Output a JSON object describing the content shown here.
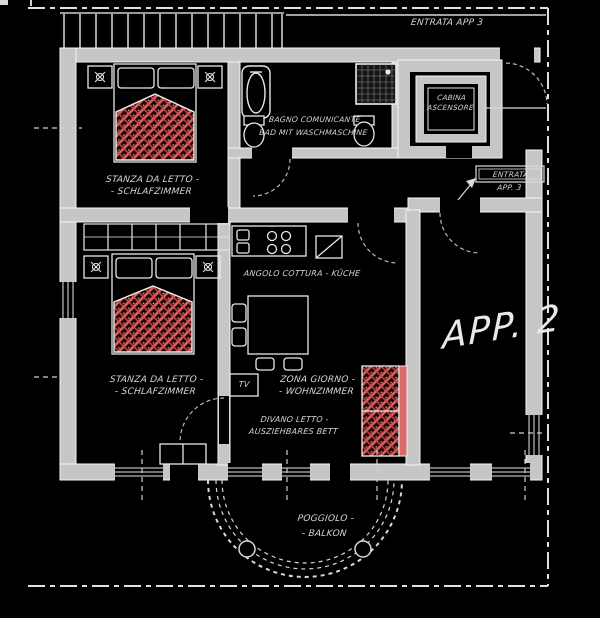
{
  "colors": {
    "background": "#000000",
    "wall_fill": "#c6c6c6",
    "line": "#e8e8e8",
    "bed_hatch_red": "#e06060",
    "bed_hatch_dark": "#1c0404",
    "text": "#d6d6d6"
  },
  "plan": {
    "top_entrance_label": "ENTRATA APP 3",
    "rooms": {
      "bedroom1": {
        "line1": "STANZA DA LETTO -",
        "line2": "- SCHLAFZIMMER"
      },
      "bedroom2": {
        "line1": "STANZA DA LETTO -",
        "line2": "- SCHLAFZIMMER"
      },
      "bathroom": {
        "line1": "BAGNO COMUNICANTE",
        "line2": "BAD MIT WASCHMASCHINE"
      },
      "elevator": {
        "line1": "CABINA",
        "line2": "ASCENSORE"
      },
      "entrance3": {
        "line1": "ENTRATA",
        "line2": "APP. 3"
      },
      "kitchen": {
        "label": "ANGOLO COTTURA - KÜCHE"
      },
      "living": {
        "line1": "ZONA GIORNO -",
        "line2": "- WOHNZIMMER"
      },
      "tv": {
        "label": "TV"
      },
      "sofabed": {
        "line1": "DIVANO LETTO -",
        "line2": "AUSZIEHBARES BETT"
      },
      "apartment": {
        "label": "APP. 2"
      },
      "balcony": {
        "line1": "POGGIOLO -",
        "line2": "- BALKON"
      }
    }
  }
}
